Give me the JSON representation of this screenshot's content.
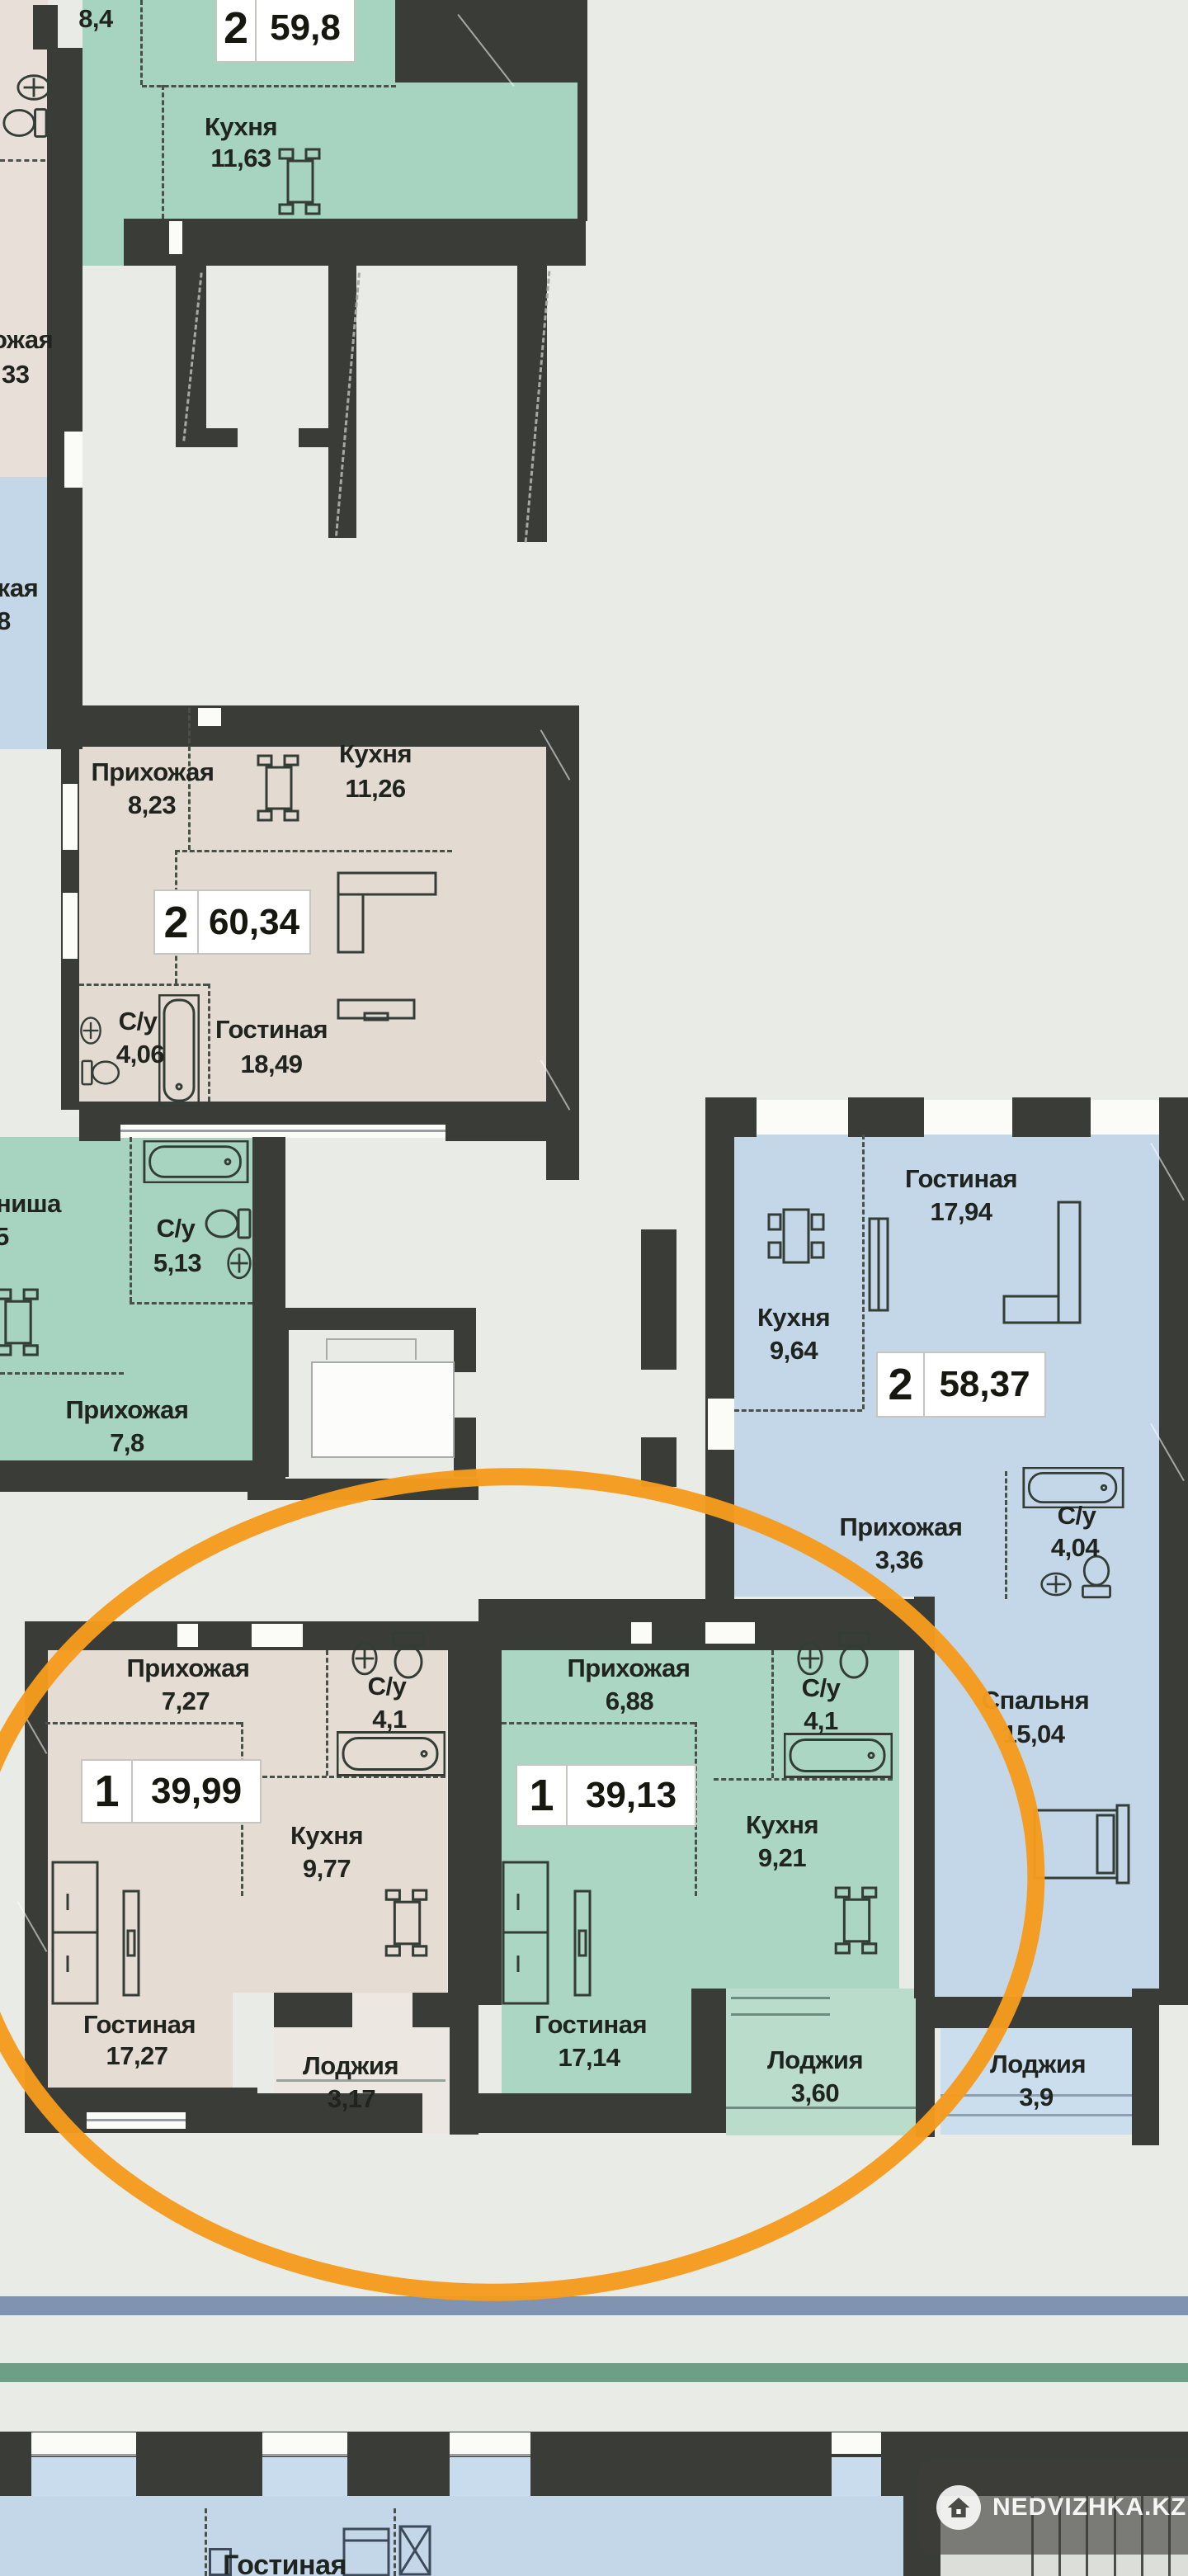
{
  "brand": {
    "watermark": "NEDVIZHKA.KZ"
  },
  "colors": {
    "wall": "#3a3c37",
    "green_room": "#a7d4c0",
    "beige_room": "#e3dad2",
    "blue_room": "#c3d7e9",
    "accent_orange": "#f59b1e",
    "stripe_blue": "#8094b2",
    "stripe_green": "#6f9e86"
  },
  "apartments": {
    "top2_598": {
      "rooms": "2",
      "total": "59,8",
      "hall_area": "8,4",
      "kitchen": "Кухня",
      "kitchen_area": "11,63"
    },
    "left_beige": {
      "hall_cut": "ожая",
      "area_cut": "33"
    },
    "left_blue": {
      "hall_cut": "жая",
      "area_cut": "8"
    },
    "mid2_6034": {
      "rooms": "2",
      "total": "60,34",
      "hall": "Прихожая",
      "hall_area": "8,23",
      "kitchen": "Кухня",
      "kitchen_area": "11,26",
      "bath": "С/у",
      "bath_area": "4,06",
      "living": "Гостиная",
      "living_area": "18,49"
    },
    "mid_green": {
      "niche_cut": "ниша",
      "niche_area_cut": "5",
      "bath": "С/у",
      "bath_area": "5,13",
      "hall": "Прихожая",
      "hall_area": "7,8"
    },
    "right2_5837": {
      "rooms": "2",
      "total": "58,37",
      "living": "Гостиная",
      "living_area": "17,94",
      "kitchen": "Кухня",
      "kitchen_area": "9,64",
      "hall": "Прихожая",
      "hall_area": "3,36",
      "bath": "С/у",
      "bath_area": "4,04",
      "bedroom": "Спальня",
      "bedroom_area": "15,04",
      "loggia": "Лоджия",
      "loggia_area": "3,9"
    },
    "bot1_3999": {
      "rooms": "1",
      "total": "39,99",
      "hall": "Прихожая",
      "hall_area": "7,27",
      "bath": "С/у",
      "bath_area": "4,1",
      "kitchen": "Кухня",
      "kitchen_area": "9,77",
      "living": "Гостиная",
      "living_area": "17,27",
      "loggia": "Лоджия",
      "loggia_area": "3,17"
    },
    "bot1_3913": {
      "rooms": "1",
      "total": "39,13",
      "hall": "Прихожая",
      "hall_area": "6,88",
      "bath": "С/у",
      "bath_area": "4,1",
      "kitchen": "Кухня",
      "kitchen_area": "9,21",
      "living": "Гостиная",
      "living_area": "17,14",
      "loggia": "Лоджия",
      "loggia_area": "3,60"
    },
    "below_floor": {
      "living": "Гостиная"
    }
  }
}
